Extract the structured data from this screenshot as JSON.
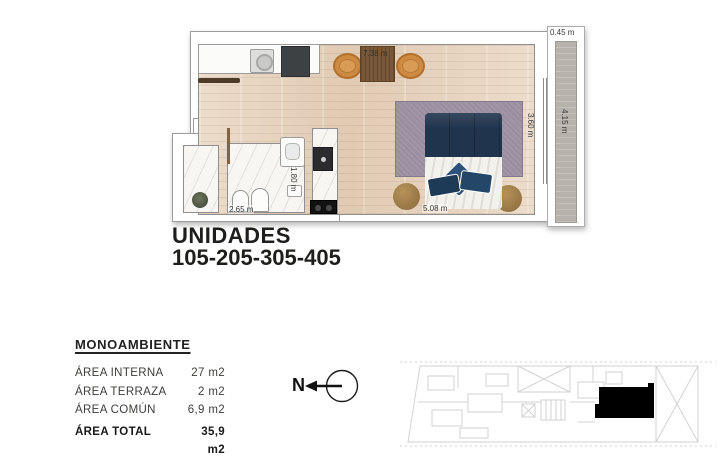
{
  "plan": {
    "dims": {
      "room_width": "7.38 m",
      "terrace_depth": "0.45 m",
      "room_depth": "3.60 m",
      "terrace_length": "4.15 m",
      "bed_wall": "5.08 m",
      "bath_width": "2.65 m",
      "bath_depth": "1.80 m"
    }
  },
  "title": {
    "line1": "UNIDADES",
    "line2": "105-205-305-405"
  },
  "areas": {
    "heading": "MONOAMBIENTE",
    "rows": [
      {
        "label": "ÁREA INTERNA",
        "value": "27 m2"
      },
      {
        "label": "ÁREA TERRAZA",
        "value": "2 m2"
      },
      {
        "label": "ÁREA COMÚN",
        "value": "6,9 m2"
      }
    ],
    "total": {
      "label": "ÁREA TOTAL",
      "value": "35,9 m2"
    }
  },
  "compass": {
    "label": "N"
  },
  "colors": {
    "floor_wood": "#e7d4c0",
    "bed_navy": "#20344d",
    "rug_mauve": "#998ea0",
    "chair_orange": "#cd8a42",
    "terrace_gray": "#b7b3ac",
    "unit_highlight": "#000000",
    "keyplan_line": "#d2d2d2",
    "text_dark": "#1e1e1c"
  }
}
